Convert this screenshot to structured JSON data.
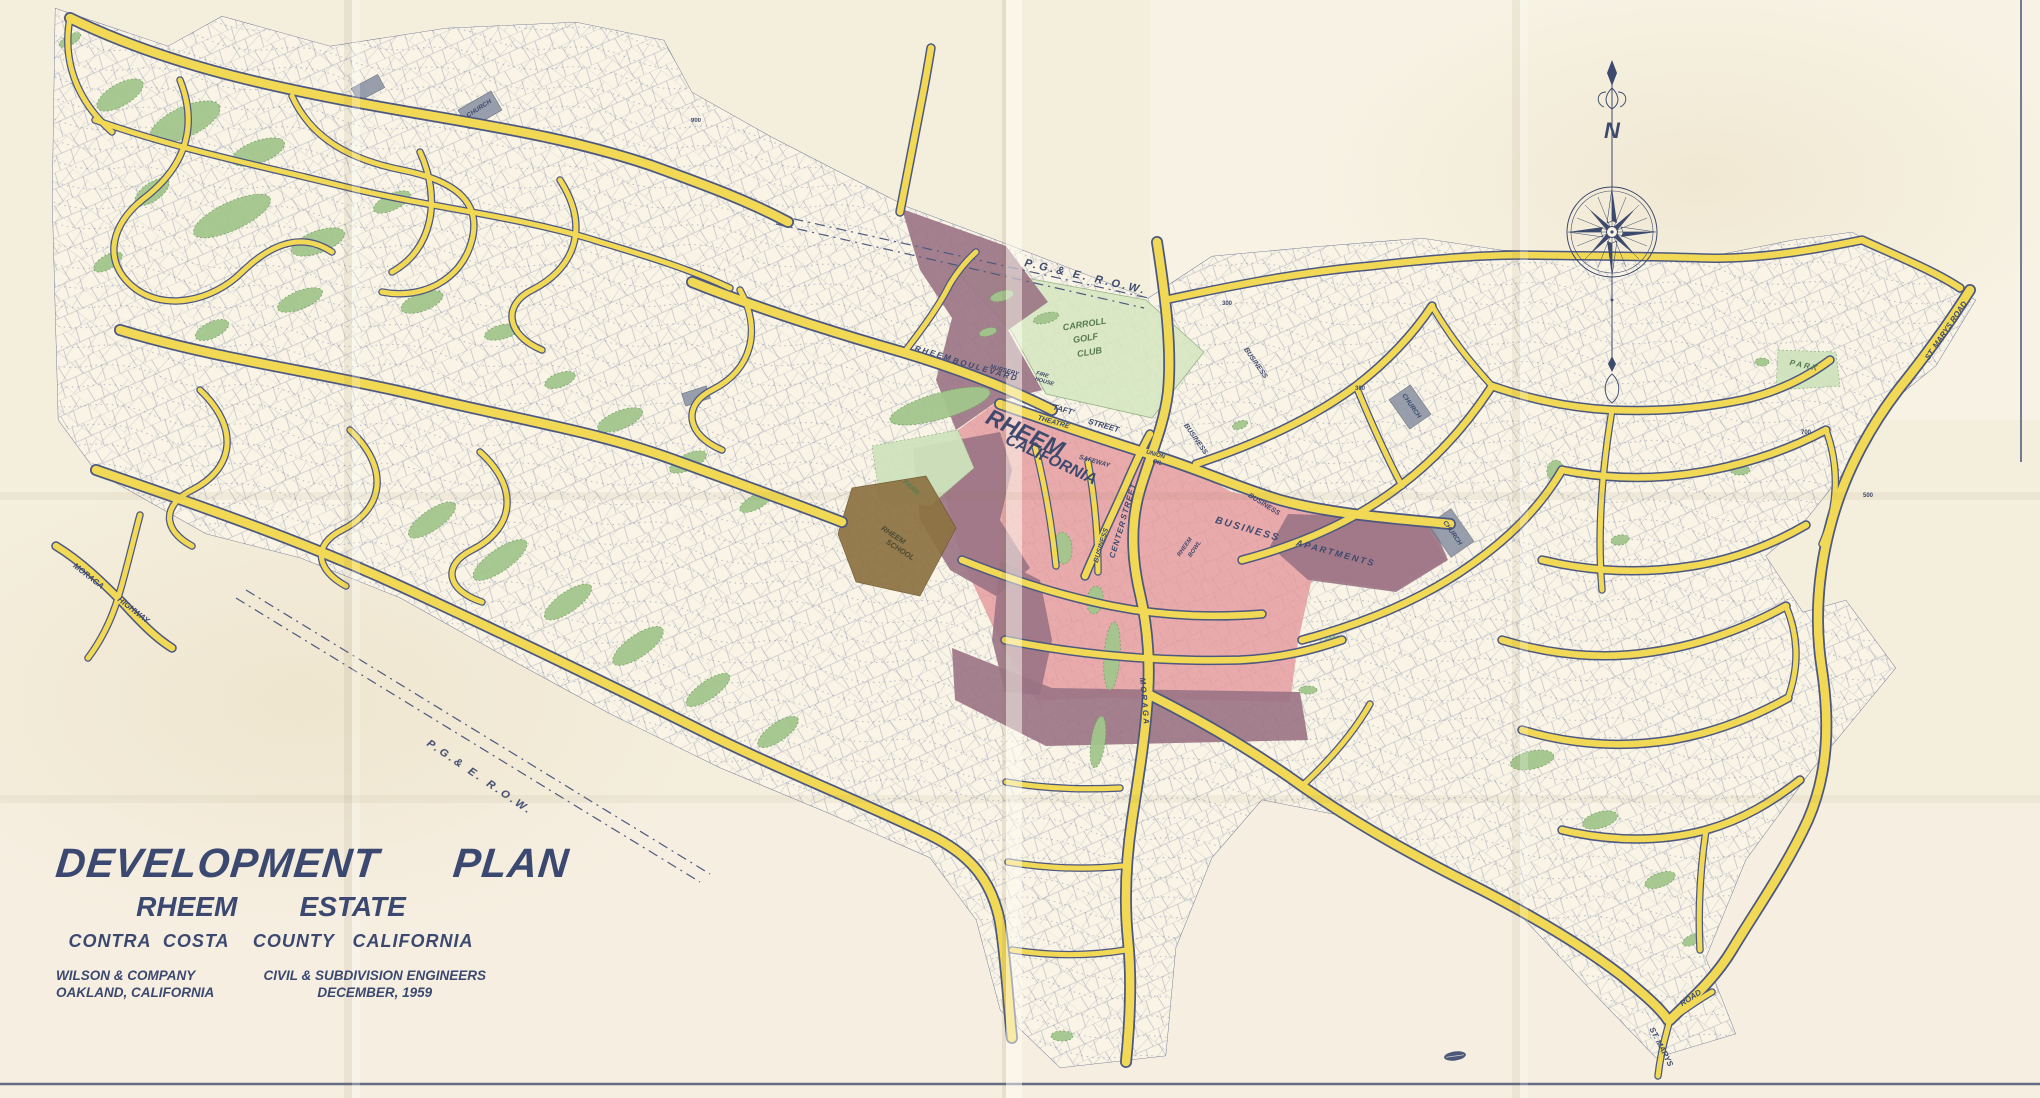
{
  "title_block": {
    "line1": "DEVELOPMENT      PLAN",
    "line2": "RHEEM        ESTATE",
    "line3": "CONTRA  COSTA    COUNTY   CALIFORNIA",
    "firm": {
      "name": "WILSON & COMPANY",
      "city": "OAKLAND, CALIFORNIA",
      "role": "CIVIL & SUBDIVISION ENGINEERS",
      "date": "DECEMBER,  1959"
    }
  },
  "compass": {
    "north_label": "N"
  },
  "colors": {
    "paper": "#f4eedd",
    "map_paper": "#f9f4e5",
    "ink_navy": "#3d4a6e",
    "road_yellow": "#f2d955",
    "road_casing": "#4d5880",
    "open_space_green": "#a3c68d",
    "golf_green": "#d7e7c3",
    "park_green": "#cfe3bd",
    "business_pink": "#e59a9e",
    "apartments_purple": "#9a7384",
    "school_brown": "#8d7242",
    "church_gray": "#8f97a6",
    "label_green": "#587a50"
  },
  "map_labels": [
    {
      "text": "P.G.& E.  R.O.W.",
      "x": 1085,
      "y": 280,
      "rot": 13,
      "size": 11,
      "spacing": 3
    },
    {
      "text": "P.G.& E.  R.O.W.",
      "x": 478,
      "y": 780,
      "rot": 34,
      "size": 11,
      "spacing": 3
    },
    {
      "text": "CARROLL",
      "x": 1085,
      "y": 327,
      "rot": -9,
      "size": 9,
      "color": "#587a50"
    },
    {
      "text": "GOLF",
      "x": 1086,
      "y": 341,
      "rot": -9,
      "size": 9,
      "color": "#587a50"
    },
    {
      "text": "CLUB",
      "x": 1090,
      "y": 355,
      "rot": -9,
      "size": 9,
      "color": "#587a50"
    },
    {
      "text": "RHEEM",
      "x": 1022,
      "y": 440,
      "rot": 25,
      "size": 23,
      "weight": "bold"
    },
    {
      "text": "CALIFORNIA",
      "x": 1049,
      "y": 464,
      "rot": 25,
      "size": 16,
      "weight": "bold"
    },
    {
      "text": "'TAFT'",
      "x": 1062,
      "y": 412,
      "rot": 16,
      "size": 8
    },
    {
      "text": "STREET",
      "x": 1103,
      "y": 428,
      "rot": 16,
      "size": 8
    },
    {
      "text": "THEATRE",
      "x": 1053,
      "y": 424,
      "rot": 16,
      "size": 7
    },
    {
      "text": "SAFEWAY",
      "x": 1094,
      "y": 463,
      "rot": 16,
      "size": 6.5
    },
    {
      "text": "UNION",
      "x": 1155,
      "y": 456,
      "rot": 16,
      "size": 6
    },
    {
      "text": "OIL",
      "x": 1157,
      "y": 464,
      "rot": 16,
      "size": 6
    },
    {
      "text": "CENTER",
      "x": 1120,
      "y": 540,
      "rot": -73,
      "size": 8,
      "spacing": 1
    },
    {
      "text": "STREET",
      "x": 1131,
      "y": 502,
      "rot": -73,
      "size": 8,
      "spacing": 1
    },
    {
      "text": "BUSINESS",
      "x": 1103,
      "y": 546,
      "rot": -73,
      "size": 7
    },
    {
      "text": "BUSINESS",
      "x": 1247,
      "y": 532,
      "rot": 16,
      "size": 10,
      "spacing": 2
    },
    {
      "text": "BUSINESS",
      "x": 1263,
      "y": 506,
      "rot": 32,
      "size": 7
    },
    {
      "text": "BUSINESS",
      "x": 1194,
      "y": 440,
      "rot": 55,
      "size": 7
    },
    {
      "text": "BUSINESS",
      "x": 1254,
      "y": 364,
      "rot": 55,
      "size": 7
    },
    {
      "text": "APARTMENTS",
      "x": 1335,
      "y": 556,
      "rot": 15,
      "size": 9,
      "spacing": 2
    },
    {
      "text": "RHEEM",
      "x": 1186,
      "y": 548,
      "rot": -55,
      "size": 6
    },
    {
      "text": "BOWL",
      "x": 1196,
      "y": 550,
      "rot": -55,
      "size": 6
    },
    {
      "text": "CHURCH",
      "x": 480,
      "y": 110,
      "rot": -33,
      "size": 6.5
    },
    {
      "text": "CHURCH",
      "x": 1410,
      "y": 407,
      "rot": 55,
      "size": 6.5
    },
    {
      "text": "CHURCH",
      "x": 1451,
      "y": 534,
      "rot": 55,
      "size": 6.5
    },
    {
      "text": "NURSERY",
      "x": 1004,
      "y": 372,
      "rot": 16,
      "size": 6
    },
    {
      "text": "FIRE",
      "x": 1042,
      "y": 376,
      "rot": 16,
      "size": 5.5
    },
    {
      "text": "HOUSE",
      "x": 1044,
      "y": 383,
      "rot": 16,
      "size": 5.5
    },
    {
      "text": "RHEEM",
      "x": 933,
      "y": 356,
      "rot": 16,
      "size": 8,
      "spacing": 2
    },
    {
      "text": "BOULEVARD",
      "x": 985,
      "y": 372,
      "rot": 16,
      "size": 8,
      "spacing": 2
    },
    {
      "text": "PARK",
      "x": 910,
      "y": 489,
      "rot": 42,
      "size": 7,
      "color": "#587a50"
    },
    {
      "text": "PARK",
      "x": 1804,
      "y": 368,
      "rot": 12,
      "size": 8,
      "spacing": 2,
      "color": "#587a50"
    },
    {
      "text": "RHEEM",
      "x": 892,
      "y": 537,
      "rot": 33,
      "size": 7.5,
      "color": "#4b4a33"
    },
    {
      "text": "SCHOOL",
      "x": 899,
      "y": 552,
      "rot": 33,
      "size": 7.5,
      "color": "#4b4a33"
    },
    {
      "text": "MORAGA",
      "x": 1142,
      "y": 702,
      "rot": 85,
      "size": 8,
      "spacing": 2
    },
    {
      "text": "MORAGA",
      "x": 87,
      "y": 578,
      "rot": 38,
      "size": 8
    },
    {
      "text": "HIGHWAY",
      "x": 132,
      "y": 612,
      "rot": 38,
      "size": 8
    },
    {
      "text": "ST. MARYS",
      "x": 1659,
      "y": 1048,
      "rot": 63,
      "size": 8
    },
    {
      "text": "ROAD",
      "x": 1692,
      "y": 1000,
      "rot": -33,
      "size": 8
    },
    {
      "text": "ST. MARYS ROAD",
      "x": 1948,
      "y": 332,
      "rot": -56,
      "size": 8
    },
    {
      "text": "900",
      "x": 696,
      "y": 122,
      "rot": 0,
      "size": 6,
      "upright": true
    },
    {
      "text": "300",
      "x": 1227,
      "y": 305,
      "rot": 0,
      "size": 6,
      "upright": true
    },
    {
      "text": "300",
      "x": 1360,
      "y": 390,
      "rot": 0,
      "size": 6,
      "upright": true
    },
    {
      "text": "700",
      "x": 1806,
      "y": 434,
      "rot": 0,
      "size": 6,
      "upright": true
    },
    {
      "text": "500",
      "x": 1868,
      "y": 497,
      "rot": 0,
      "size": 6,
      "upright": true
    }
  ]
}
